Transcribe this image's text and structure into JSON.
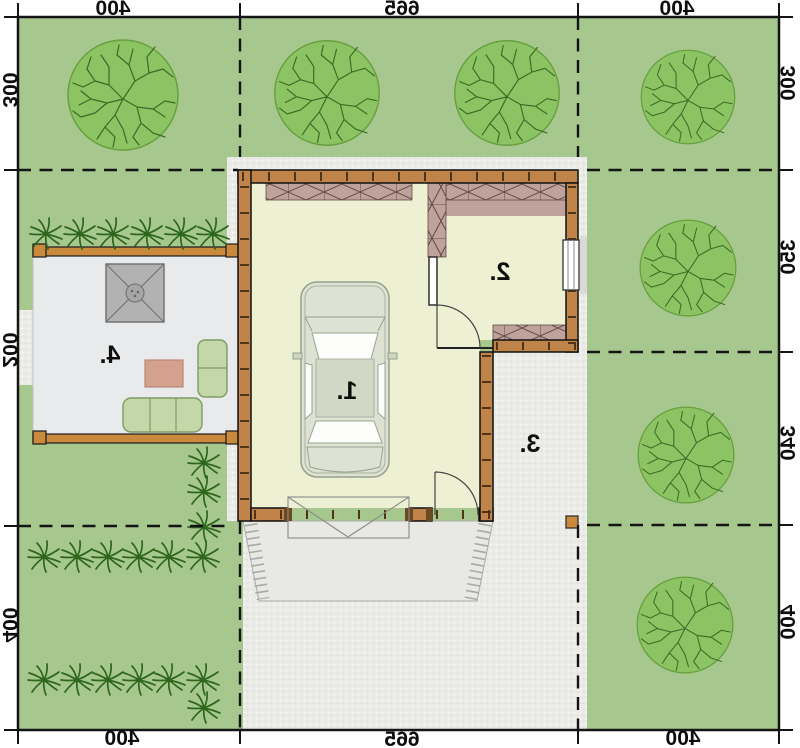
{
  "plan": {
    "kind": "site-plan-floorplan",
    "mirrored_text": true
  },
  "dimensions_cm": {
    "top": [
      "400",
      "665",
      "400"
    ],
    "bottom": [
      "400",
      "665",
      "400"
    ],
    "left": [
      "300",
      "200",
      "400"
    ],
    "right": [
      "300",
      "350",
      "340",
      "400"
    ]
  },
  "rooms": [
    {
      "label": "1."
    },
    {
      "label": "2."
    },
    {
      "label": "3."
    },
    {
      "label": "4."
    }
  ],
  "palette": {
    "lawn": "#a6c88f",
    "tree_canopy": "#8cc363",
    "tree_branches": "#3b6b24",
    "bush": "#2e661c",
    "paving_gray": "#ebebe8",
    "floor_cream": "#eef0d4",
    "wall_wood": "#c08349",
    "hatch_mauve": "#bfa29b",
    "deck_gray": "#e9eaec",
    "car_body": "#dde2d2",
    "parasol_gray": "#b2b2b2",
    "sofa_green": "#c3d7a9",
    "table_tan": "#d3a18e",
    "line_black": "#141414"
  }
}
